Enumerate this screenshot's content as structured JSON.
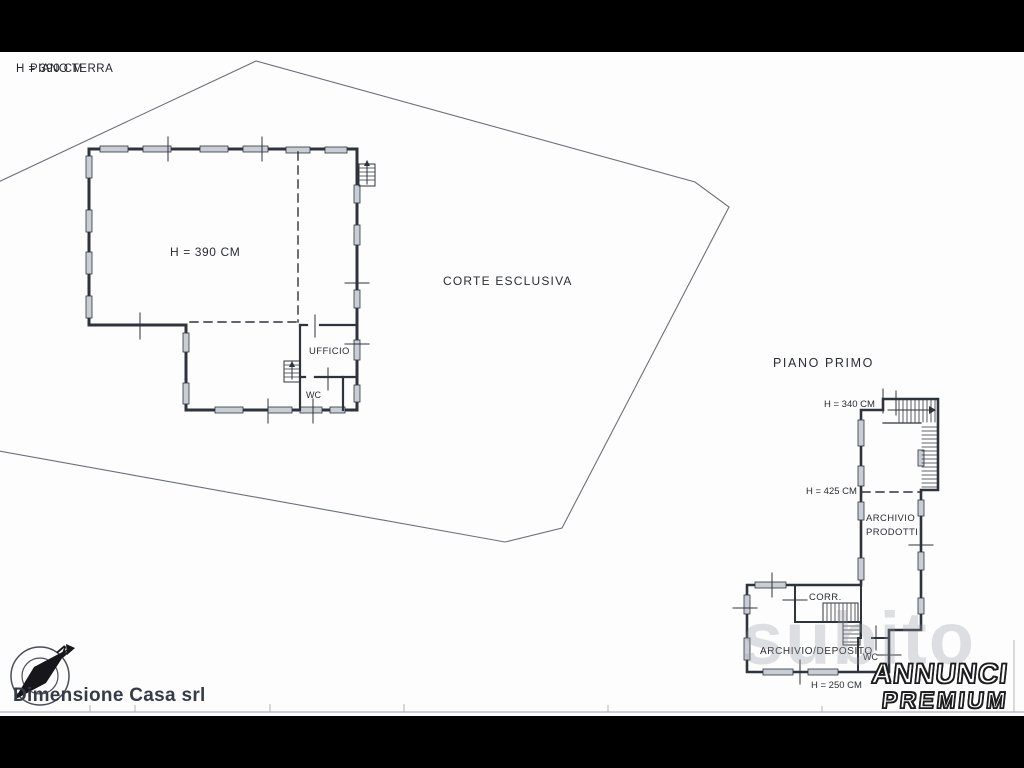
{
  "page": {
    "background": "#fdfdfd",
    "letterbox_color": "#000000",
    "line_color": "#2f333b",
    "boundary_color": "#6b7078",
    "window_fill": "#c9cdd4",
    "watermark_color": "rgba(148,153,163,0.30)"
  },
  "titles": {
    "overlap_height": "H = 390 CM",
    "overlap_floor": "PIANO TERRA",
    "first_floor": "PIANO PRIMO"
  },
  "ground_floor": {
    "height_label": "H = 390 CM",
    "court_label": "CORTE ESCLUSIVA",
    "rooms": {
      "office": "UFFICIO",
      "wc": "WC"
    }
  },
  "first_floor": {
    "height_top": "H = 340 CM",
    "height_mid": "H = 425 CM",
    "height_bottom": "H = 250 CM",
    "rooms": {
      "archive_line1": "ARCHIVIO",
      "archive_line2": "PRODOTTI",
      "corridor": "CORR.",
      "archive_deposit": "ARCHIVIO/DEPOSITO",
      "wc": "WC"
    }
  },
  "branding": {
    "agency": "Dimensione Casa srl",
    "watermark": "subito",
    "logo_line1": "ANNUNCI",
    "logo_line2": "PREMIUM",
    "compass_north": "N"
  }
}
